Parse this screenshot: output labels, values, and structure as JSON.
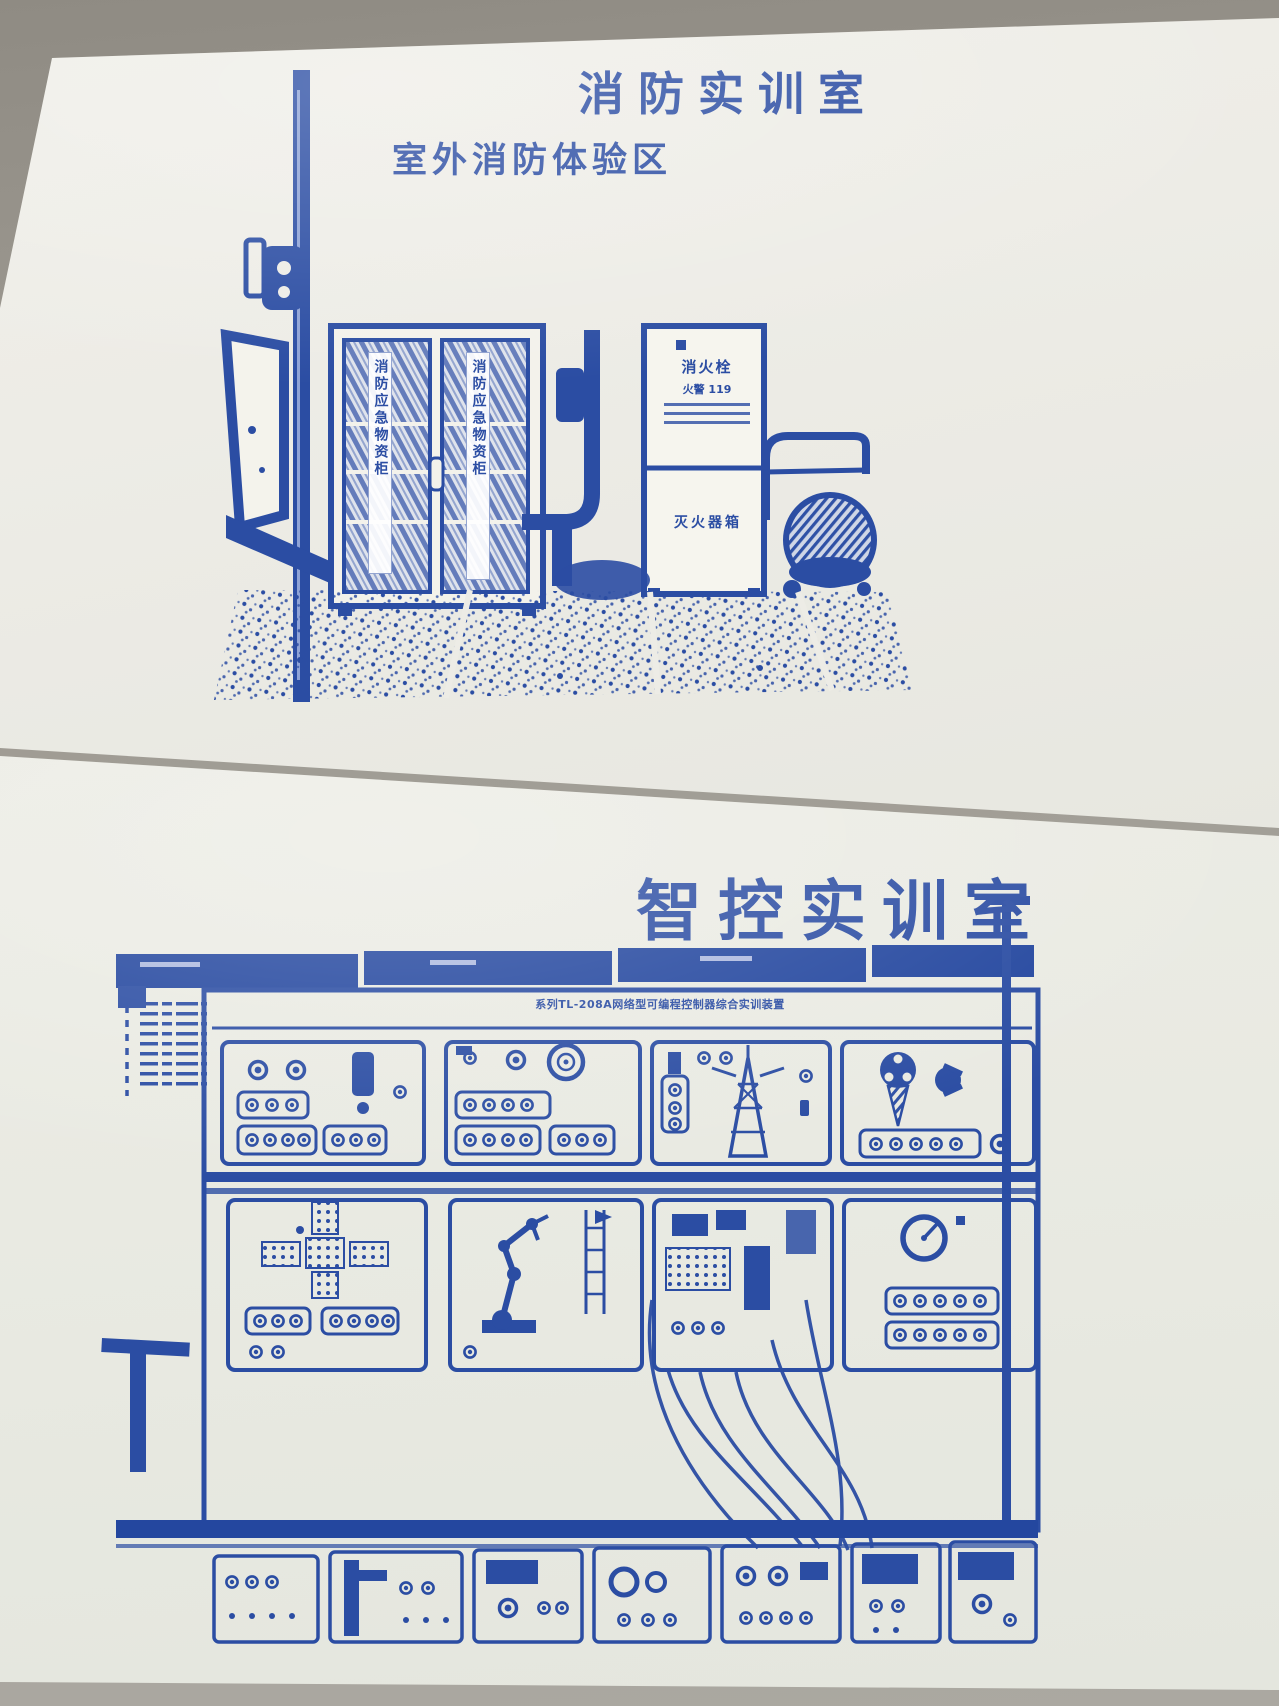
{
  "photo": {
    "backdrop_color": "#9a968e"
  },
  "colors": {
    "ink": "#2b4da3",
    "ink_dark": "#1f3d8f",
    "paper_top": "#edece6",
    "paper_bottom": "#e9eae2"
  },
  "board_top": {
    "title": "消防实训室",
    "subtitle": "室外消防体验区",
    "cabinet": {
      "left_door_label": "消防应急物资柜",
      "right_door_label": "消防应急物资柜"
    },
    "hydrant": {
      "line1": "消火栓",
      "line2": "火警 119",
      "bottom_label": "灭火器箱"
    }
  },
  "board_bottom": {
    "title": "智控实训室",
    "equipment_label": "系列TL-208A网络型可编程控制器综合实训装置"
  }
}
